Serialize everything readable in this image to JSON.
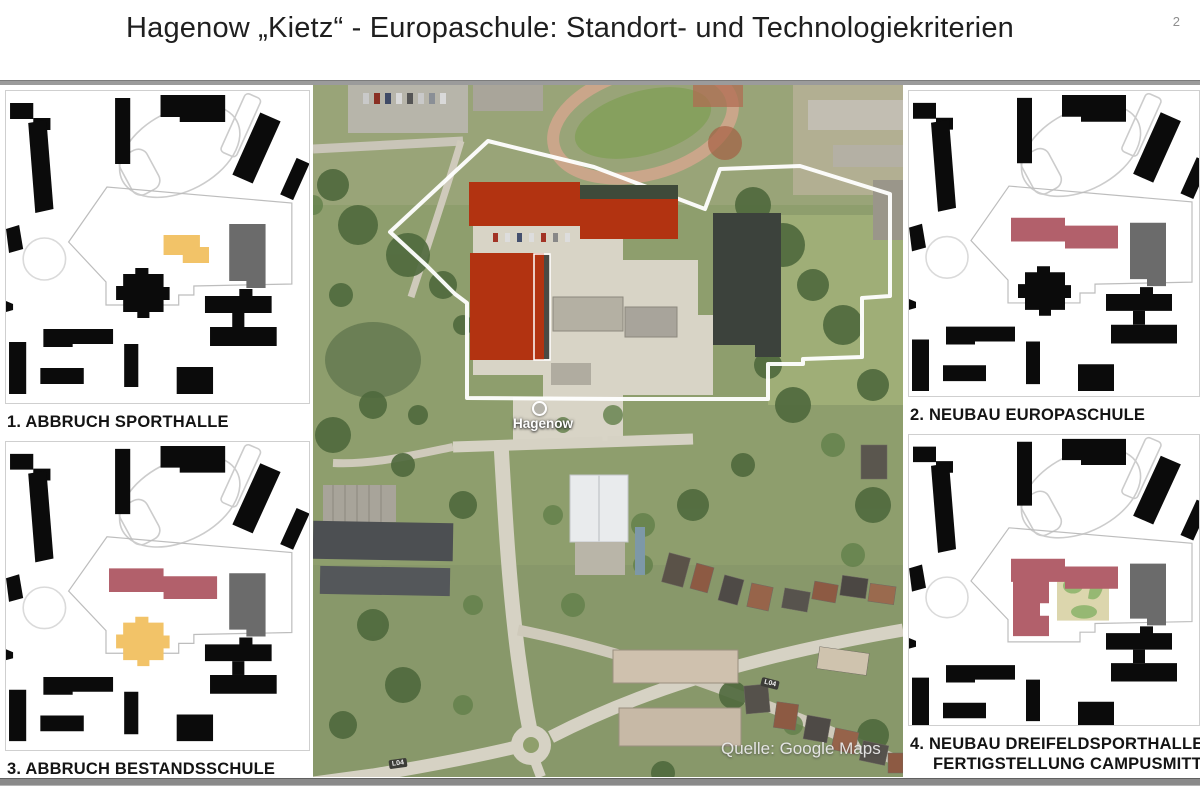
{
  "slide": {
    "title": "Hagenow „Kietz“ - Europaschule: Standort- und Technologiekriterien",
    "page_number": "2"
  },
  "panels": [
    {
      "label": "1. ABBRUCH SPORTHALLE"
    },
    {
      "label": "2. NEUBAU EUROPASCHULE"
    },
    {
      "label": "3. ABBRUCH BESTANDSSCHULE"
    },
    {
      "label_line1": "4. NEUBAU DREIFELDSPORTHALLE/",
      "label_line2": "FERTIGSTELLUNG CAMPUSMITTE"
    }
  ],
  "map": {
    "place_label": "Hagenow",
    "attribution": "Quelle: Google Maps",
    "road_label": "L04"
  },
  "colors": {
    "demolition_red": "#b23311",
    "new_rose": "#b2606b",
    "abbruch_amber": "#f2c368",
    "existing_gray": "#6b6b6b",
    "park_green": "#96b873",
    "park_tan": "#dcd6ad"
  }
}
